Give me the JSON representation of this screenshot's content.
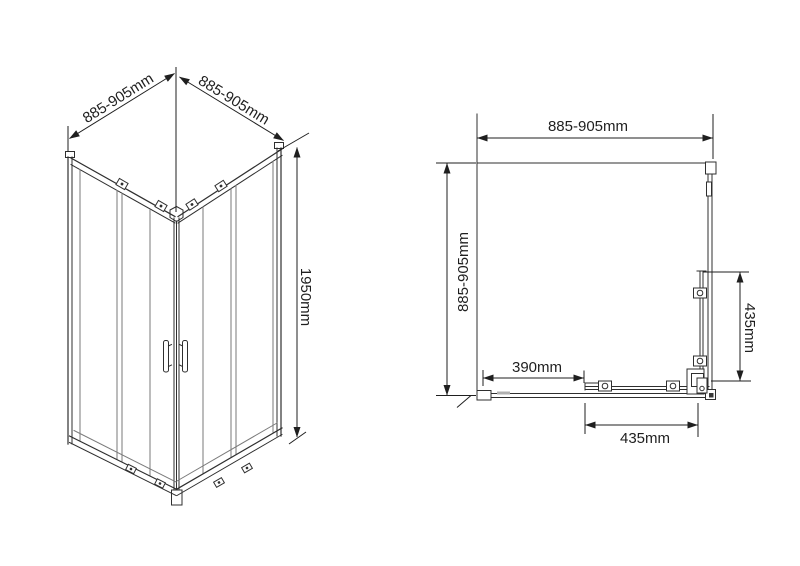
{
  "drawing": {
    "type": "shower-enclosure-dimension-diagram",
    "colors": {
      "background": "#ffffff",
      "frame_line": "#2f2f2f",
      "glass_line": "#7a7a7a",
      "dimension_line": "#1f1f1f",
      "text": "#1f1f1f"
    }
  },
  "isometric_view": {
    "width_left_label": "885-905mm",
    "width_right_label": "885-905mm",
    "height_label": "1950mm"
  },
  "plan_view": {
    "width_label": "885-905mm",
    "depth_label": "885-905mm",
    "offset_label": "390mm",
    "right_panel_label": "435mm",
    "bottom_panel_label": "435mm"
  }
}
